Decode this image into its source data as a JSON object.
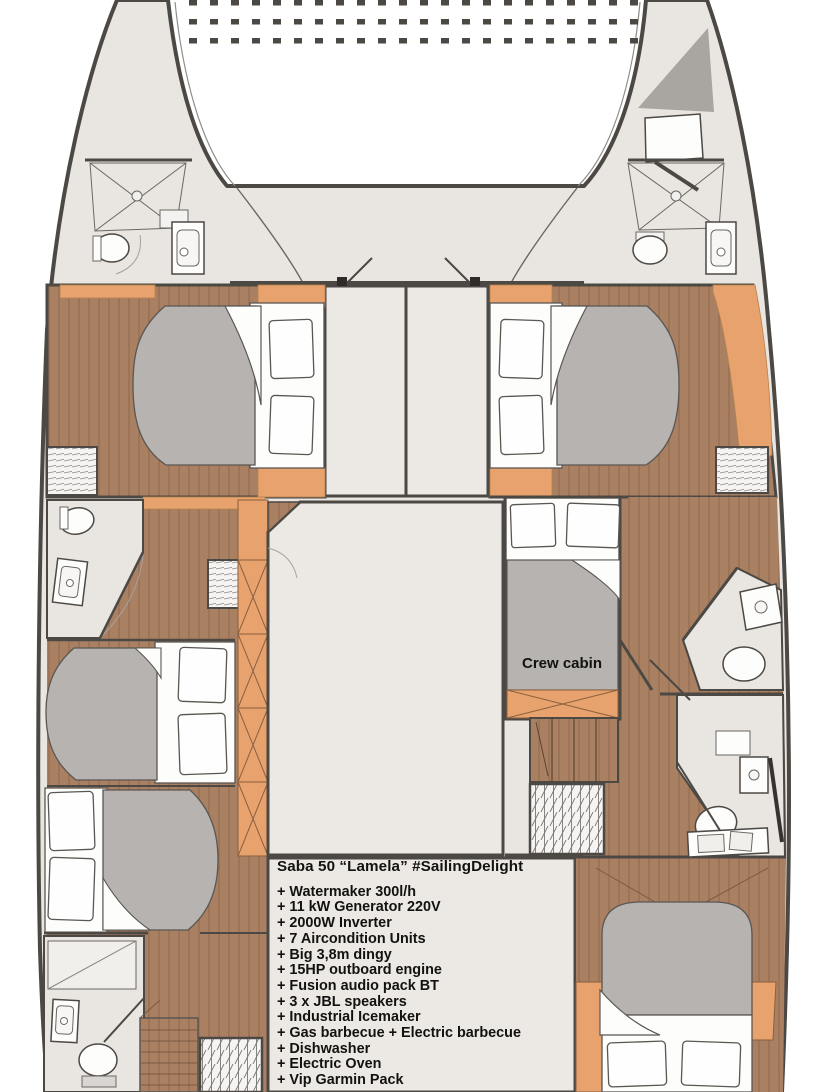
{
  "title": "Saba 50 “Lamela” #SailingDelight",
  "labels": {
    "crew_cabin": "Crew cabin"
  },
  "features": {
    "items": [
      "+ Watermaker 300l/h",
      "+ 11 kW Generator 220V",
      "+ 2000W Inverter",
      "+ 7 Aircondition Units",
      "+ Big 3,8m dingy",
      "+ 15HP outboard engine",
      "+ Fusion audio pack BT",
      "+ 3 x JBL speakers",
      "+ Industrial Icemaker",
      "+ Gas barbecue + Electric barbecue",
      "+ Dishwasher",
      "+ Electric Oven",
      "+ Vip Garmin Pack"
    ]
  },
  "colors": {
    "body_gray": "#e9e5e1",
    "panel_gray": "#ece9e5",
    "wood": "#aa8063",
    "wood_line": "#936c51",
    "accent_orange": "#e8a26d",
    "duvet_gray": "#b7b3b0",
    "shade_gray": "#a9a5a1",
    "wall_dark": "#4c4844",
    "fixture_white": "#fdfdfc",
    "text_black": "#121210"
  }
}
